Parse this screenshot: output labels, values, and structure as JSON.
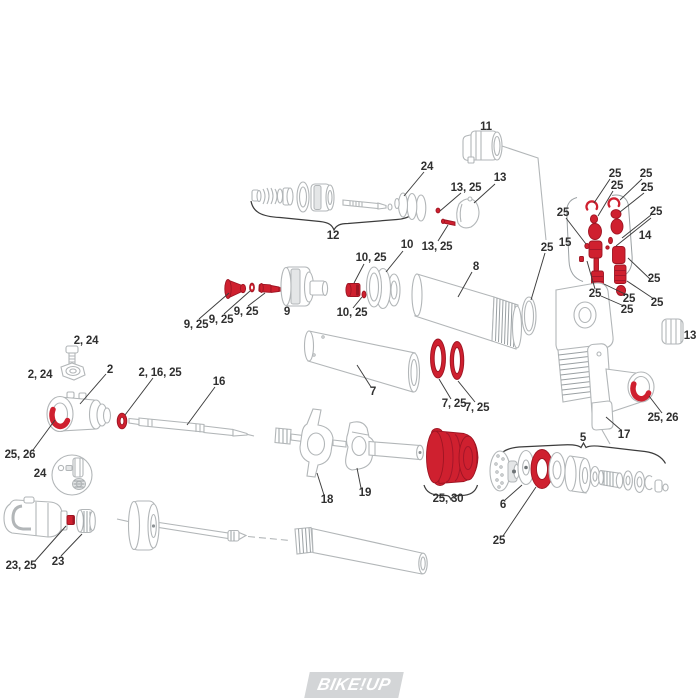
{
  "page": {
    "background_color": "#ffffff"
  },
  "watermark": {
    "text": "BIKE!UP",
    "box_color": "#d3d5d7",
    "text_color": "#ffffff"
  },
  "diagram": {
    "title": "Rear shock absorber exploded parts diagram",
    "highlight_color": "#cf202f",
    "outline_color": "#b2b6b8",
    "label_color": "#303030",
    "callouts": [
      {
        "text": "24",
        "x": 427,
        "y": 167
      },
      {
        "text": "12",
        "x": 333,
        "y": 236
      },
      {
        "text": "13, 25",
        "x": 466,
        "y": 188
      },
      {
        "text": "13",
        "x": 500,
        "y": 178
      },
      {
        "text": "13, 25",
        "x": 437,
        "y": 247
      },
      {
        "text": "11",
        "x": 486,
        "y": 127
      },
      {
        "text": "25",
        "x": 615,
        "y": 174
      },
      {
        "text": "25",
        "x": 617,
        "y": 186
      },
      {
        "text": "25",
        "x": 646,
        "y": 174
      },
      {
        "text": "25",
        "x": 647,
        "y": 188
      },
      {
        "text": "25",
        "x": 563,
        "y": 213
      },
      {
        "text": "25",
        "x": 656,
        "y": 212
      },
      {
        "text": "15",
        "x": 565,
        "y": 243
      },
      {
        "text": "14",
        "x": 645,
        "y": 236
      },
      {
        "text": "25",
        "x": 654,
        "y": 279
      },
      {
        "text": "25",
        "x": 595,
        "y": 294
      },
      {
        "text": "25",
        "x": 629,
        "y": 299
      },
      {
        "text": "25",
        "x": 627,
        "y": 310
      },
      {
        "text": "25",
        "x": 657,
        "y": 303
      },
      {
        "text": "25",
        "x": 547,
        "y": 248
      },
      {
        "text": "8",
        "x": 476,
        "y": 267
      },
      {
        "text": "10",
        "x": 407,
        "y": 245
      },
      {
        "text": "10, 25",
        "x": 371,
        "y": 258
      },
      {
        "text": "10, 25",
        "x": 352,
        "y": 313
      },
      {
        "text": "9",
        "x": 287,
        "y": 312
      },
      {
        "text": "9, 25",
        "x": 246,
        "y": 312
      },
      {
        "text": "9, 25",
        "x": 221,
        "y": 320
      },
      {
        "text": "9, 25",
        "x": 196,
        "y": 325
      },
      {
        "text": "7",
        "x": 373,
        "y": 392
      },
      {
        "text": "7, 25",
        "x": 454,
        "y": 404
      },
      {
        "text": "7, 25",
        "x": 477,
        "y": 408
      },
      {
        "text": "13",
        "x": 690,
        "y": 336
      },
      {
        "text": "25, 26",
        "x": 663,
        "y": 418
      },
      {
        "text": "17",
        "x": 624,
        "y": 435
      },
      {
        "text": "2, 24",
        "x": 86,
        "y": 341
      },
      {
        "text": "2, 24",
        "x": 40,
        "y": 375
      },
      {
        "text": "2",
        "x": 110,
        "y": 370
      },
      {
        "text": "2, 16, 25",
        "x": 160,
        "y": 373
      },
      {
        "text": "16",
        "x": 219,
        "y": 382
      },
      {
        "text": "25, 26",
        "x": 20,
        "y": 455
      },
      {
        "text": "24",
        "x": 40,
        "y": 474
      },
      {
        "text": "18",
        "x": 327,
        "y": 500
      },
      {
        "text": "19",
        "x": 365,
        "y": 493
      },
      {
        "text": "25, 30",
        "x": 448,
        "y": 499
      },
      {
        "text": "5",
        "x": 583,
        "y": 438
      },
      {
        "text": "6",
        "x": 503,
        "y": 505
      },
      {
        "text": "25",
        "x": 499,
        "y": 541
      },
      {
        "text": "23, 25",
        "x": 21,
        "y": 566
      },
      {
        "text": "23",
        "x": 58,
        "y": 562
      }
    ],
    "leader_lines": [
      [
        424,
        172,
        404,
        196
      ],
      [
        461,
        193,
        440,
        211
      ],
      [
        495,
        184,
        474,
        203
      ],
      [
        438,
        241,
        448,
        225
      ],
      [
        610,
        179,
        594,
        203
      ],
      [
        613,
        191,
        598,
        216
      ],
      [
        642,
        179,
        620,
        200
      ],
      [
        644,
        193,
        620,
        212
      ],
      [
        566,
        218,
        586,
        244
      ],
      [
        651,
        215,
        622,
        238
      ],
      [
        651,
        218,
        616,
        246
      ],
      [
        650,
        279,
        628,
        258
      ],
      [
        595,
        289,
        587,
        261
      ],
      [
        627,
        295,
        604,
        284
      ],
      [
        624,
        306,
        601,
        296
      ],
      [
        654,
        299,
        627,
        281
      ],
      [
        545,
        253,
        531,
        300
      ],
      [
        472,
        272,
        458,
        297
      ],
      [
        403,
        251,
        386,
        272
      ],
      [
        364,
        264,
        354,
        283
      ],
      [
        353,
        308,
        362,
        297
      ],
      [
        248,
        306,
        265,
        293
      ],
      [
        224,
        314,
        250,
        291
      ],
      [
        199,
        319,
        229,
        293
      ],
      [
        371,
        387,
        357,
        365
      ],
      [
        451,
        399,
        439,
        379
      ],
      [
        475,
        402,
        458,
        381
      ],
      [
        662,
        413,
        649,
        396
      ],
      [
        621,
        430,
        606,
        417
      ],
      [
        106,
        374,
        80,
        404
      ],
      [
        153,
        378,
        125,
        415
      ],
      [
        215,
        387,
        187,
        425
      ],
      [
        33,
        450,
        55,
        420
      ],
      [
        324,
        495,
        317,
        473
      ],
      [
        361,
        488,
        357,
        468
      ],
      [
        505,
        500,
        522,
        485
      ],
      [
        503,
        536,
        536,
        487
      ],
      [
        35,
        561,
        66,
        526
      ],
      [
        61,
        556,
        82,
        534
      ]
    ]
  }
}
